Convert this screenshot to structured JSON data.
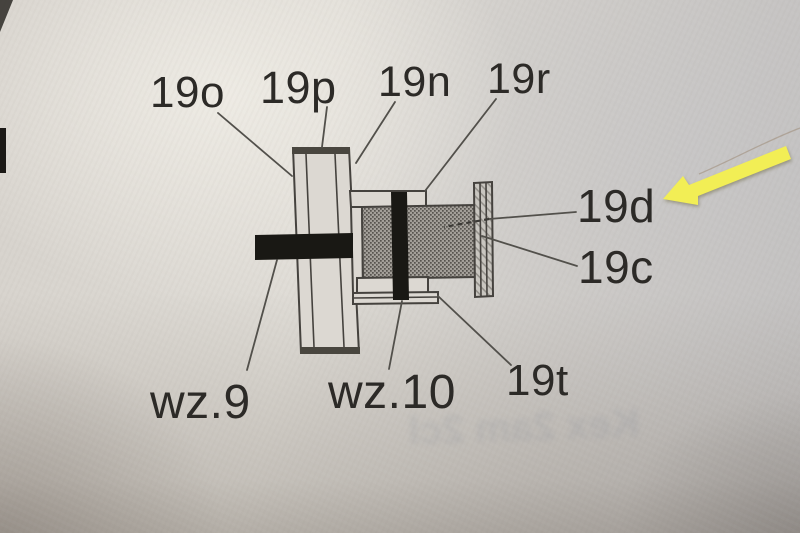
{
  "figure": {
    "type": "technical-cross-section-diagram",
    "labels": {
      "19o": "19o",
      "19p": "19p",
      "19n": "19n",
      "19r": "19r",
      "19d": "19d",
      "19c": "19c",
      "19t": "19t",
      "wz9": "wz.9",
      "wz10": "wz.10"
    },
    "highlight": {
      "arrow_color": "#f2ee55",
      "points_to_label": "19d"
    },
    "colors": {
      "paper": "#d8d4ce",
      "line": "#45423e",
      "solid_black_parts": "#191814",
      "hatched_cylinder": "#8f8c86",
      "end_plate": "#c6c3bd"
    }
  },
  "artifacts": {
    "ghost_text": "Kex 2am 2cl"
  }
}
